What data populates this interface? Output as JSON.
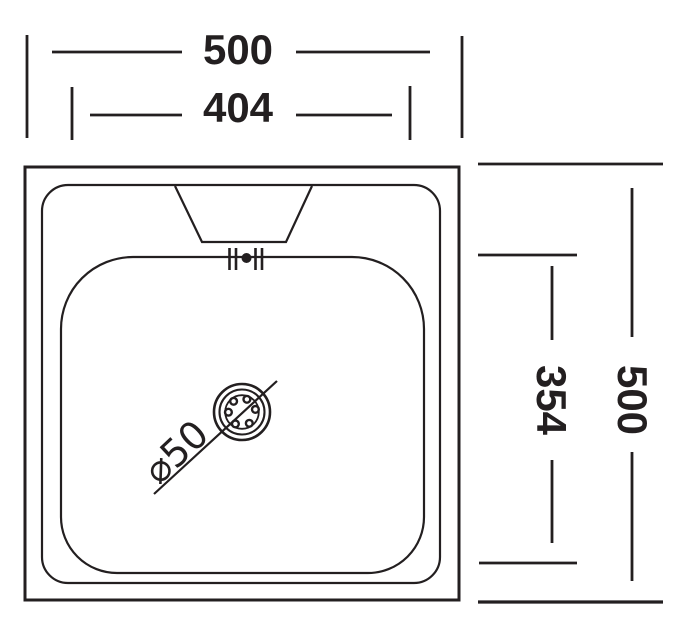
{
  "drawing": {
    "background": "#ffffff",
    "line_color": "#231f20",
    "dimensions": {
      "outer_width": "500",
      "inner_width": "404",
      "outer_height": "500",
      "inner_height": "354",
      "drain_diameter": "⌀50"
    }
  }
}
